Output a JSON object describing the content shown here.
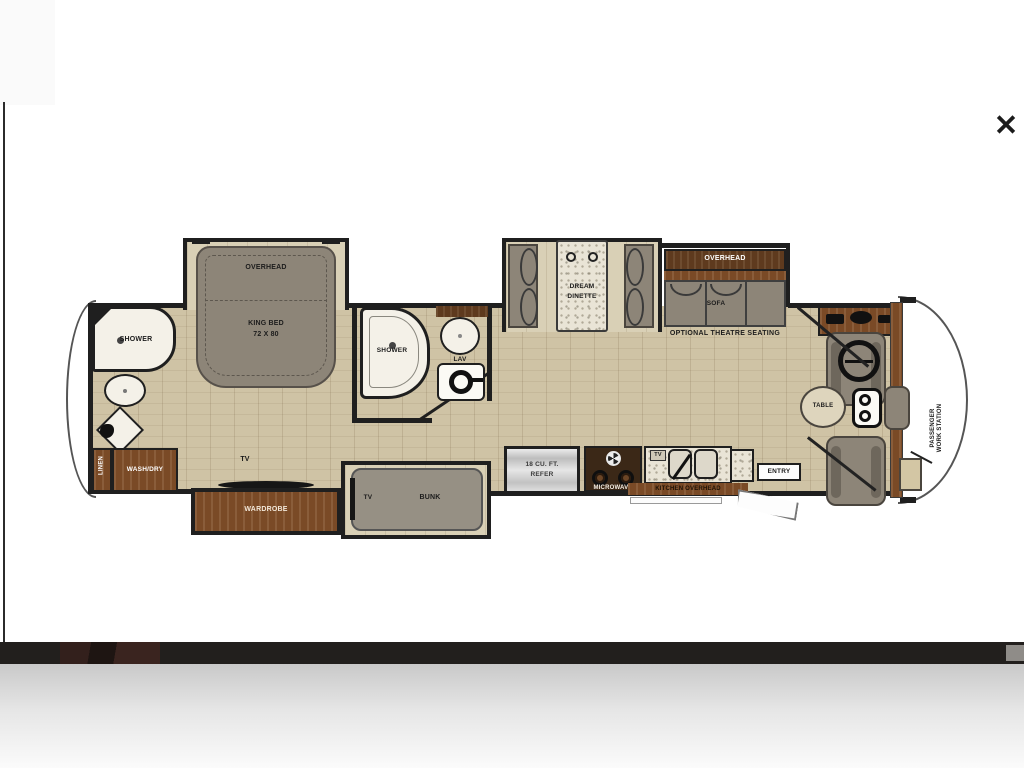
{
  "viewer": {
    "close_icon": "✕"
  },
  "plan": {
    "rear_bath": {
      "shower": "SHOWER",
      "linen": "LINEN",
      "wash_dry": "WASH/DRY"
    },
    "bedroom": {
      "overhead": "OVERHEAD",
      "bed_line1": "KING BED",
      "bed_line2": "72 X 80",
      "tv": "TV",
      "wardrobe": "WARDROBE"
    },
    "mid_bath": {
      "shower": "SHOWER",
      "lav": "LAV"
    },
    "bunk_room": {
      "tv": "TV",
      "bunk": "BUNK"
    },
    "dinette": {
      "line1": "DREAM",
      "line2": "DINETTE"
    },
    "living": {
      "overhead": "OVERHEAD",
      "sofa": "SOFA",
      "theatre_note": "OPTIONAL THEATRE SEATING"
    },
    "kitchen": {
      "refer_line1": "18 CU. FT.",
      "refer_line2": "REFER",
      "microwave": "MICROWAVE",
      "tv": "TV",
      "overhead": "KITCHEN OVERHEAD",
      "entry": "ENTRY"
    },
    "cockpit": {
      "table": "TABLE",
      "ws_line1": "PASSENGER",
      "ws_line2": "WORK STATION"
    }
  },
  "colors": {
    "wall": "#1f1f1f",
    "floor": "#cfc3a5",
    "cabinet": "#7a4a26",
    "furniture_gray": "#8d8578",
    "page_bg": "#ffffff"
  }
}
